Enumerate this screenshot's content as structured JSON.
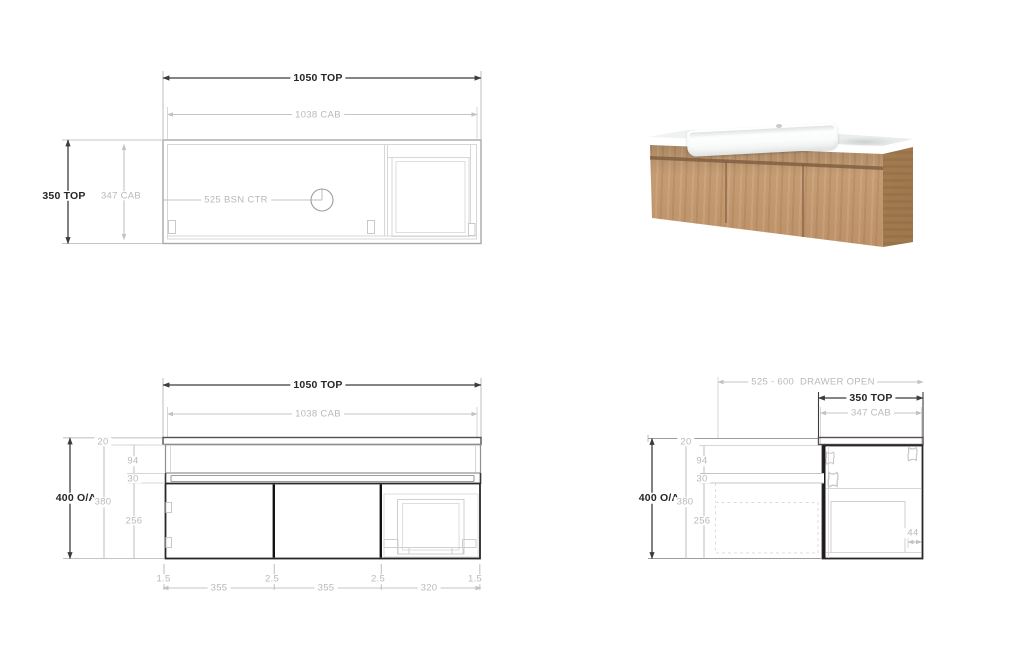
{
  "plan": {
    "top_width": "1050 TOP",
    "cab_width": "1038 CAB",
    "top_depth": "350 TOP",
    "cab_depth": "347 CAB",
    "basin_center": "525 BSN CTR"
  },
  "front": {
    "top_width": "1050 TOP",
    "cab_width": "1038 CAB",
    "overall_height": "400 O/A",
    "top_thickness": "20",
    "drawer_band": "94",
    "reveal": "30",
    "cab_height": "380",
    "door_height": "256",
    "edge_left": "1.5",
    "door1_width": "355",
    "gap1": "2.5",
    "door2_width": "355",
    "gap2": "2.5",
    "door3_width": "320",
    "edge_right": "1.5"
  },
  "side": {
    "drawer_open": "525 - 600  DRAWER OPEN",
    "top_depth": "350 TOP",
    "cab_depth": "347 CAB",
    "overall_height": "400 O/A",
    "top_thickness": "20",
    "drawer_band": "94",
    "reveal": "30",
    "cab_height": "380",
    "door_height": "256",
    "back_gap": "44"
  },
  "colors": {
    "line_dark": "#3f3b3c",
    "line_light": "#c4c4c4",
    "text_dark": "#2a2526",
    "text_gray": "#b9b9b9",
    "wood": "#c59c73",
    "wood_dark": "#a87e53",
    "counter_white": "#fbfcfc",
    "groove": "#7c5c40"
  }
}
